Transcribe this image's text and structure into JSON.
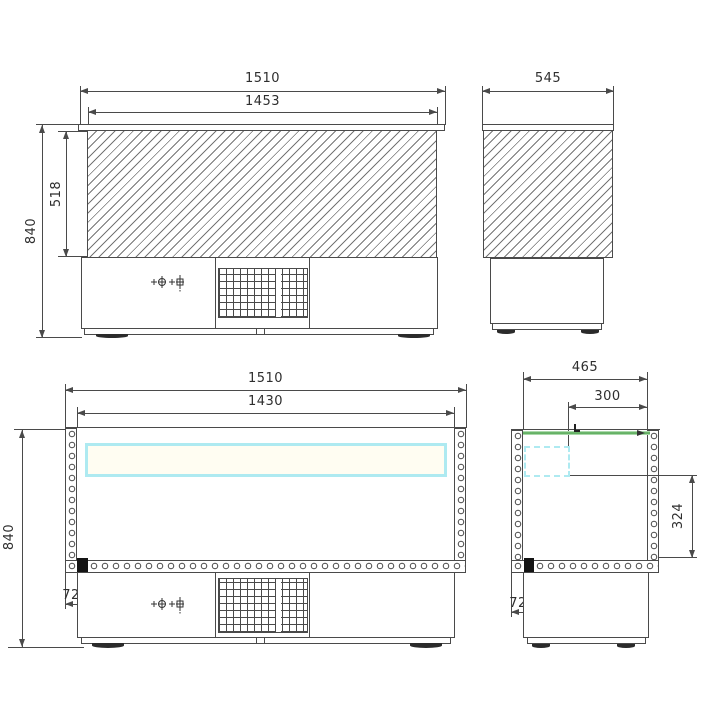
{
  "drawing": {
    "type": "technical-dimensional-drawing",
    "colors": {
      "line": "#4a4a4a",
      "hatch": "#757575",
      "glass_shelf_cyan": "#aeeaf1",
      "lid_green": "#58aa58",
      "drain_black": "#141414"
    },
    "icons": {
      "control_panel": "thermostat-knob-and-switch-crosshair-icons",
      "wall_fill": "insulation-circles",
      "front_panel_fill": "diagonal-hatch",
      "vent": "ventilation-grille-grid"
    },
    "views": {
      "front_elevation": {
        "dim_overall_width": "1510",
        "dim_glass_width": "1453",
        "dim_glass_height": "518",
        "dim_overall_height": "840"
      },
      "side_elevation": {
        "dim_overall_depth": "545"
      },
      "front_section": {
        "dim_overall_width": "1510",
        "dim_inner_width": "1430",
        "dim_overall_height": "840",
        "dim_drain_offset": "72"
      },
      "side_section": {
        "dim_inner_depth": "465",
        "dim_lid_depth": "300",
        "dim_inner_height": "324",
        "dim_drain_offset": "72"
      }
    }
  }
}
